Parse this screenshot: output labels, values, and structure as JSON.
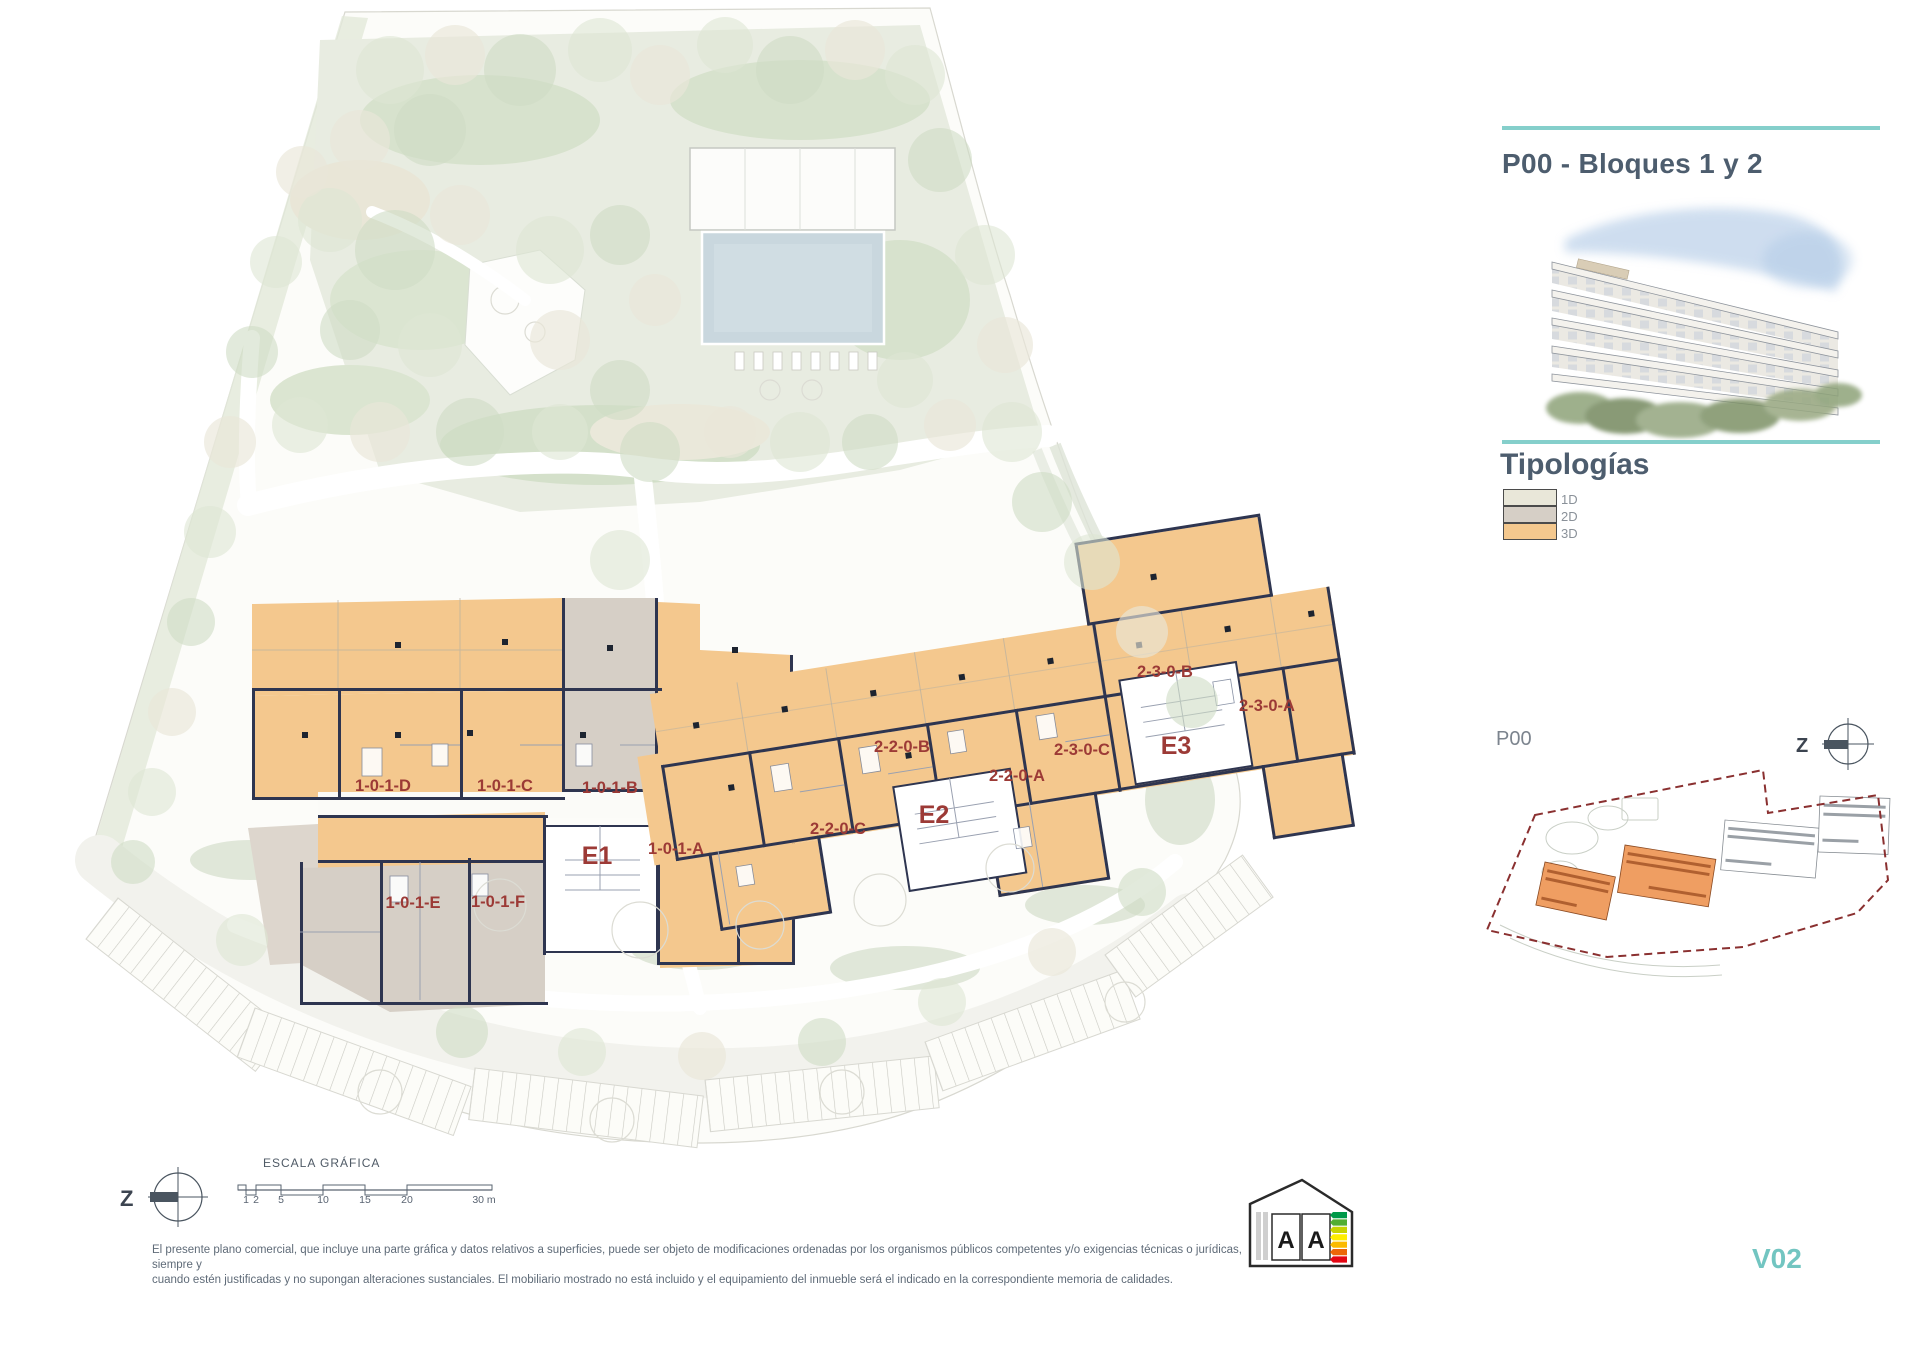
{
  "panel": {
    "title": "P00 - Bloques 1 y 2",
    "typologies_title": "Tipologías",
    "legend": [
      {
        "label": "1D",
        "color": "#e9e7d9"
      },
      {
        "label": "2D",
        "color": "#d6cfc6"
      },
      {
        "label": "3D",
        "color": "#f4c88e"
      }
    ],
    "minimap_label": "P00",
    "minimap_compass_letter": "Z"
  },
  "plan": {
    "units": [
      {
        "id": "1-0-1-D",
        "x": 383,
        "y": 791
      },
      {
        "id": "1-0-1-C",
        "x": 505,
        "y": 791
      },
      {
        "id": "1-0-1-B",
        "x": 610,
        "y": 793
      },
      {
        "id": "1-0-1-A",
        "x": 676,
        "y": 854
      },
      {
        "id": "1-0-1-E",
        "x": 413,
        "y": 908
      },
      {
        "id": "1-0-1-F",
        "x": 498,
        "y": 907
      },
      {
        "id": "2-2-0-C",
        "x": 838,
        "y": 834
      },
      {
        "id": "2-2-0-B",
        "x": 902,
        "y": 752
      },
      {
        "id": "2-2-0-A",
        "x": 1017,
        "y": 781
      },
      {
        "id": "2-3-0-C",
        "x": 1082,
        "y": 755
      },
      {
        "id": "2-3-0-B",
        "x": 1165,
        "y": 677
      },
      {
        "id": "2-3-0-A",
        "x": 1267,
        "y": 711
      }
    ],
    "cores": [
      {
        "id": "E1",
        "x": 597,
        "y": 864
      },
      {
        "id": "E2",
        "x": 934,
        "y": 823
      },
      {
        "id": "E3",
        "x": 1176,
        "y": 754
      }
    ]
  },
  "scale_bar": {
    "title": "ESCALA GRÁFICA",
    "ticks": [
      "1",
      "2",
      "5",
      "10",
      "15",
      "20",
      "30 m"
    ],
    "compass_letter": "Z"
  },
  "footer": {
    "disclaimer_line1": "El presente plano comercial, que incluye una parte gráfica y datos relativos a superficies, puede ser objeto de modificaciones ordenadas por los organismos públicos competentes y/o exigencias técnicas o jurídicas, siempre y",
    "disclaimer_line2": "cuando estén justificadas y no supongan alteraciones sustanciales. El mobiliario mostrado no está incluido y el equipamiento del inmueble será el indicado en la correspondiente memoria de calidades.",
    "version": "V02",
    "energy_letters": [
      "A",
      "A"
    ],
    "energy_colors": [
      "#009949",
      "#52ae32",
      "#c8d400",
      "#ffed00",
      "#fbba00",
      "#ec6608",
      "#e30613"
    ]
  },
  "colors": {
    "teal": "#85cfcb",
    "heading": "#4d5d6e",
    "unit_red": "#9c3a36",
    "t1d": "#e9e7d9",
    "t2d": "#d6cfc6",
    "t3d": "#f4c88e",
    "wall": "#2e3550",
    "version_teal": "#72c5c1",
    "minimap_orange": "#ef9e62",
    "legend_text": "#8a9199",
    "muted": "#5f6b78"
  }
}
